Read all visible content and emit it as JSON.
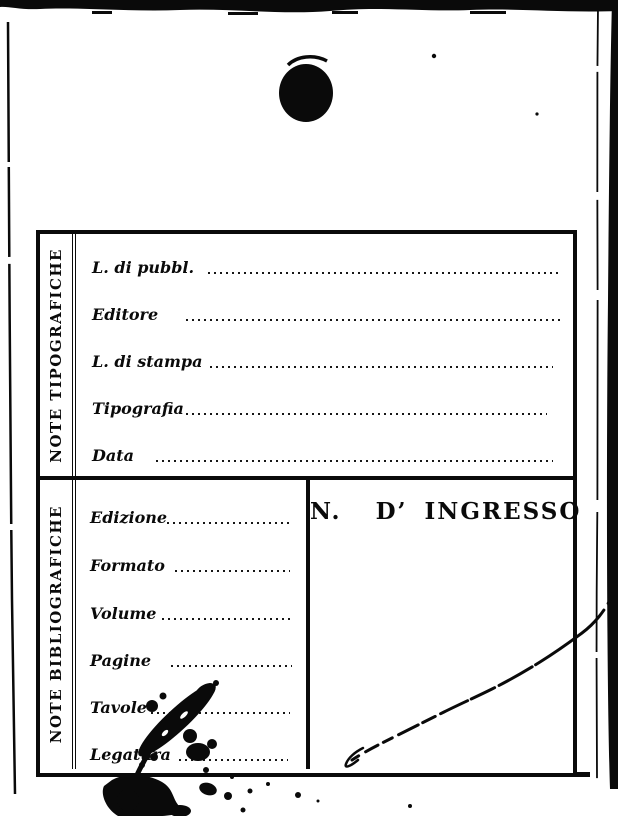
{
  "colors": {
    "ink": "#0a0a0a",
    "paper": "#ffffff"
  },
  "card": {
    "typographic_section": {
      "side_label": "NOTE TIPOGRAFICHE",
      "fields": [
        {
          "label": "L. di pubbl."
        },
        {
          "label": "Editore"
        },
        {
          "label": "L. di stampa"
        },
        {
          "label": "Tipografia"
        },
        {
          "label": "Data"
        }
      ]
    },
    "bibliographic_section": {
      "side_label": "NOTE BIBLIOGRAFICHE",
      "fields": [
        {
          "label": "Edizione"
        },
        {
          "label": "Formato"
        },
        {
          "label": "Volume"
        },
        {
          "label": "Pagine"
        },
        {
          "label": "Tavole"
        },
        {
          "label": "Legatura"
        }
      ],
      "ingresso_label": "N.  D’ INGRESSO"
    }
  }
}
